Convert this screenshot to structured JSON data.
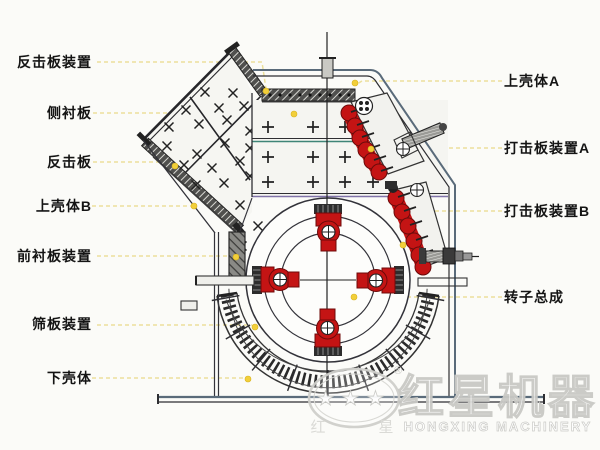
{
  "diagram_title": "impact-crusher-structure-diagram",
  "labels": {
    "left": [
      {
        "id": "impact-plate-assembly",
        "text": "反击板装置"
      },
      {
        "id": "side-liner-plate",
        "text": "侧衬板"
      },
      {
        "id": "impact-plate",
        "text": "反击板"
      },
      {
        "id": "upper-shell-b",
        "text": "上壳体B"
      },
      {
        "id": "front-liner-assembly",
        "text": "前衬板装置"
      },
      {
        "id": "screen-plate-assembly",
        "text": "筛板装置"
      },
      {
        "id": "lower-shell",
        "text": "下壳体"
      }
    ],
    "right": [
      {
        "id": "upper-shell-a",
        "text": "上壳体A"
      },
      {
        "id": "striking-plate-assembly-a",
        "text": "打击板装置A"
      },
      {
        "id": "striking-plate-assembly-b",
        "text": "打击板装置B"
      },
      {
        "id": "rotor-assembly",
        "text": "转子总成"
      }
    ]
  },
  "watermark": {
    "stars": "★★★",
    "logo_char_left": "红",
    "logo_char_right": "星",
    "registered_mark": "®",
    "brand_cn": "红星机器",
    "brand_en": "HONGXING MACHINERY"
  },
  "colors": {
    "background": "#fbfbf8",
    "line_dark": "#2e2e32",
    "component_red": "#c41414",
    "leader_line_yellow": "#ece09c",
    "leader_dot_yellow": "#f2cf3a",
    "teal_line": "#3f8577",
    "purple_line": "#8073a8",
    "base_blue_gray": "#5a6b7a",
    "watermark_gray": "#c9c9c5"
  }
}
